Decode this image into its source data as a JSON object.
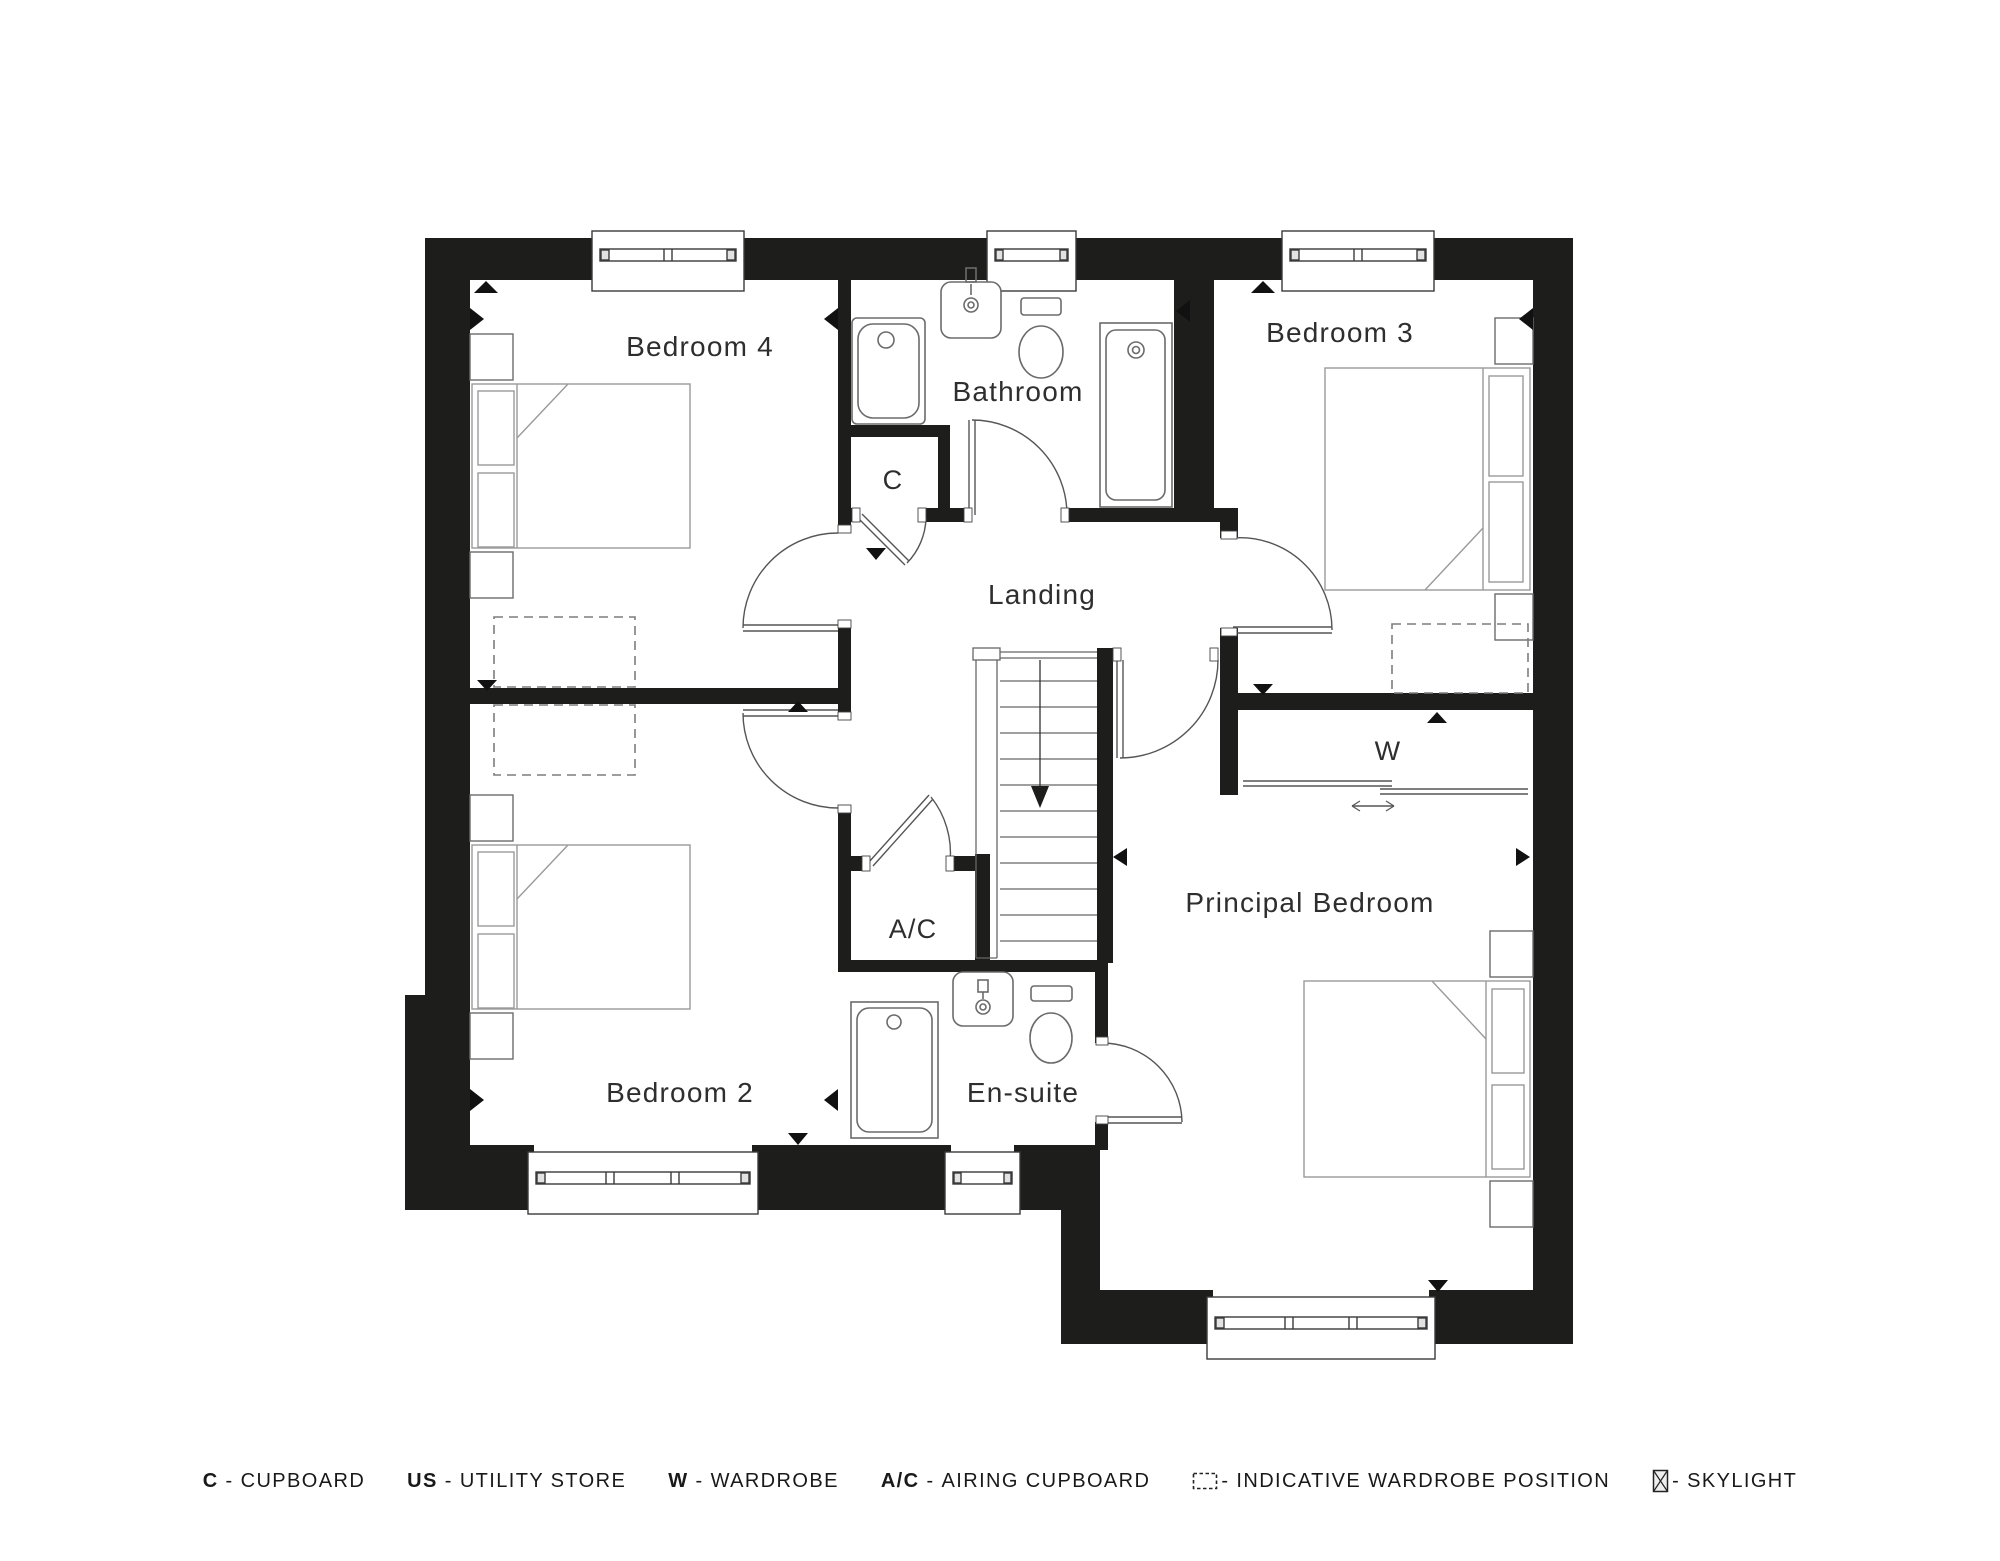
{
  "plan": {
    "rooms": {
      "bedroom4": "Bedroom 4",
      "bathroom": "Bathroom",
      "bedroom3": "Bedroom 3",
      "cupboard": "C",
      "landing": "Landing",
      "wardrobe": "W",
      "airing_cupboard": "A/C",
      "bedroom2": "Bedroom 2",
      "ensuite": "En-suite",
      "principal_bedroom": "Principal Bedroom"
    }
  },
  "legend": {
    "items": [
      {
        "key": "C",
        "sep": "-",
        "label": "CUPBOARD"
      },
      {
        "key": "US",
        "sep": "-",
        "label": "UTILITY STORE"
      },
      {
        "key": "W",
        "sep": "-",
        "label": "WARDROBE"
      },
      {
        "key": "A/C",
        "sep": "-",
        "label": "AIRING CUPBOARD"
      },
      {
        "icon": "indicative-wardrobe-icon",
        "sep": "-",
        "label": "INDICATIVE WARDROBE POSITION"
      },
      {
        "icon": "skylight-icon",
        "sep": "-",
        "label": "SKYLIGHT"
      }
    ]
  },
  "colors": {
    "wall": "#1d1d1b",
    "text": "#2e2e2e",
    "legend_text": "#191919"
  }
}
